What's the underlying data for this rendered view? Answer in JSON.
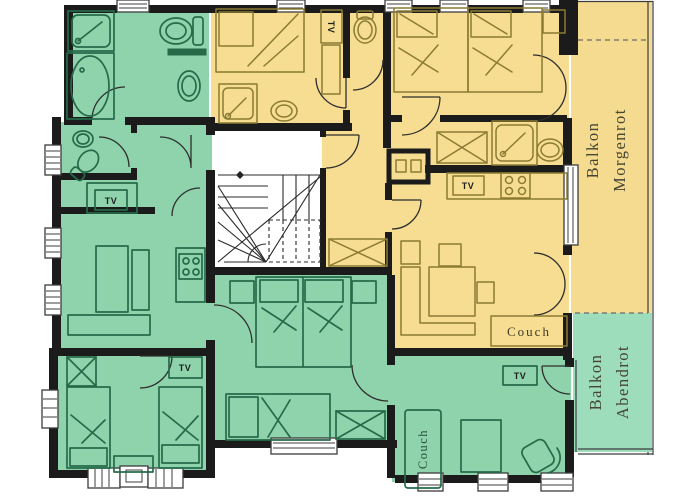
{
  "title": "Apartment floor plan",
  "colors": {
    "wall": "#1b1b1b",
    "green_room": "#8fd3ac",
    "green_balcony": "#9dddbc",
    "yellow_room": "#f6dd92",
    "yellow_balcony": "#f5db8f",
    "green_line": "#256b49",
    "yellow_line": "#8b7b33",
    "stair_line": "#2b2b2b",
    "tv_text": "#1e1e1e",
    "couch_text_yellow": "#3c3c28",
    "couch_text_green": "#274d3a",
    "balcony_text": "#454532"
  },
  "labels": {
    "tv": "TV",
    "couch": "Couch",
    "balkon_morgenrot": {
      "line1": "Balkon",
      "line2": "Morgenrot"
    },
    "balkon_abendrot": {
      "line1": "Balkon",
      "line2": "Abendrot"
    }
  }
}
